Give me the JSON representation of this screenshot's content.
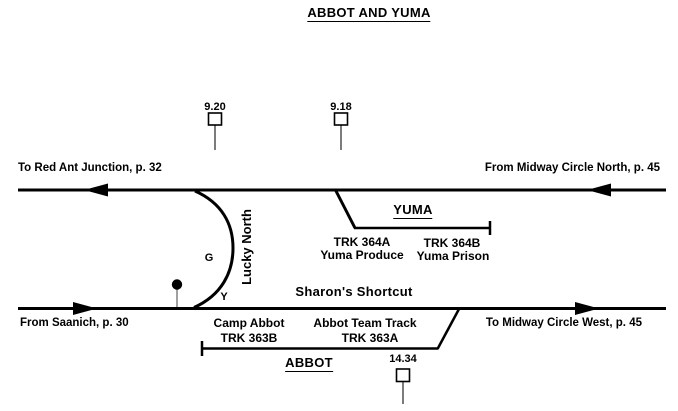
{
  "title": "ABBOT AND YUMA",
  "colors": {
    "ink": "#000000",
    "background": "#ffffff",
    "stem_gray": "#888888",
    "milepost_stem": "#444444"
  },
  "mileposts": {
    "mp1": "9.20",
    "mp2": "9.18",
    "mp3": "14.34"
  },
  "main_top": {
    "left_label": "To Red Ant Junction, p. 32",
    "right_label": "From Midway Circle North, p. 45"
  },
  "main_bottom": {
    "left_label": "From Saanich, p. 30",
    "right_label": "To Midway Circle West, p. 45"
  },
  "siding": {
    "name": "Lucky North",
    "switch_g": "G",
    "switch_y": "Y"
  },
  "shortcut_label": "Sharon's Shortcut",
  "yuma": {
    "name": "YUMA",
    "track_a": {
      "number": "TRK 364A",
      "label": "Yuma Produce"
    },
    "track_b": {
      "number": "TRK 364B",
      "label": "Yuma Prison"
    }
  },
  "abbot": {
    "name": "ABBOT",
    "track_b": {
      "number": "TRK 363B",
      "label": "Camp Abbot"
    },
    "track_a": {
      "number": "TRK 363A",
      "label": "Abbot Team Track"
    }
  }
}
